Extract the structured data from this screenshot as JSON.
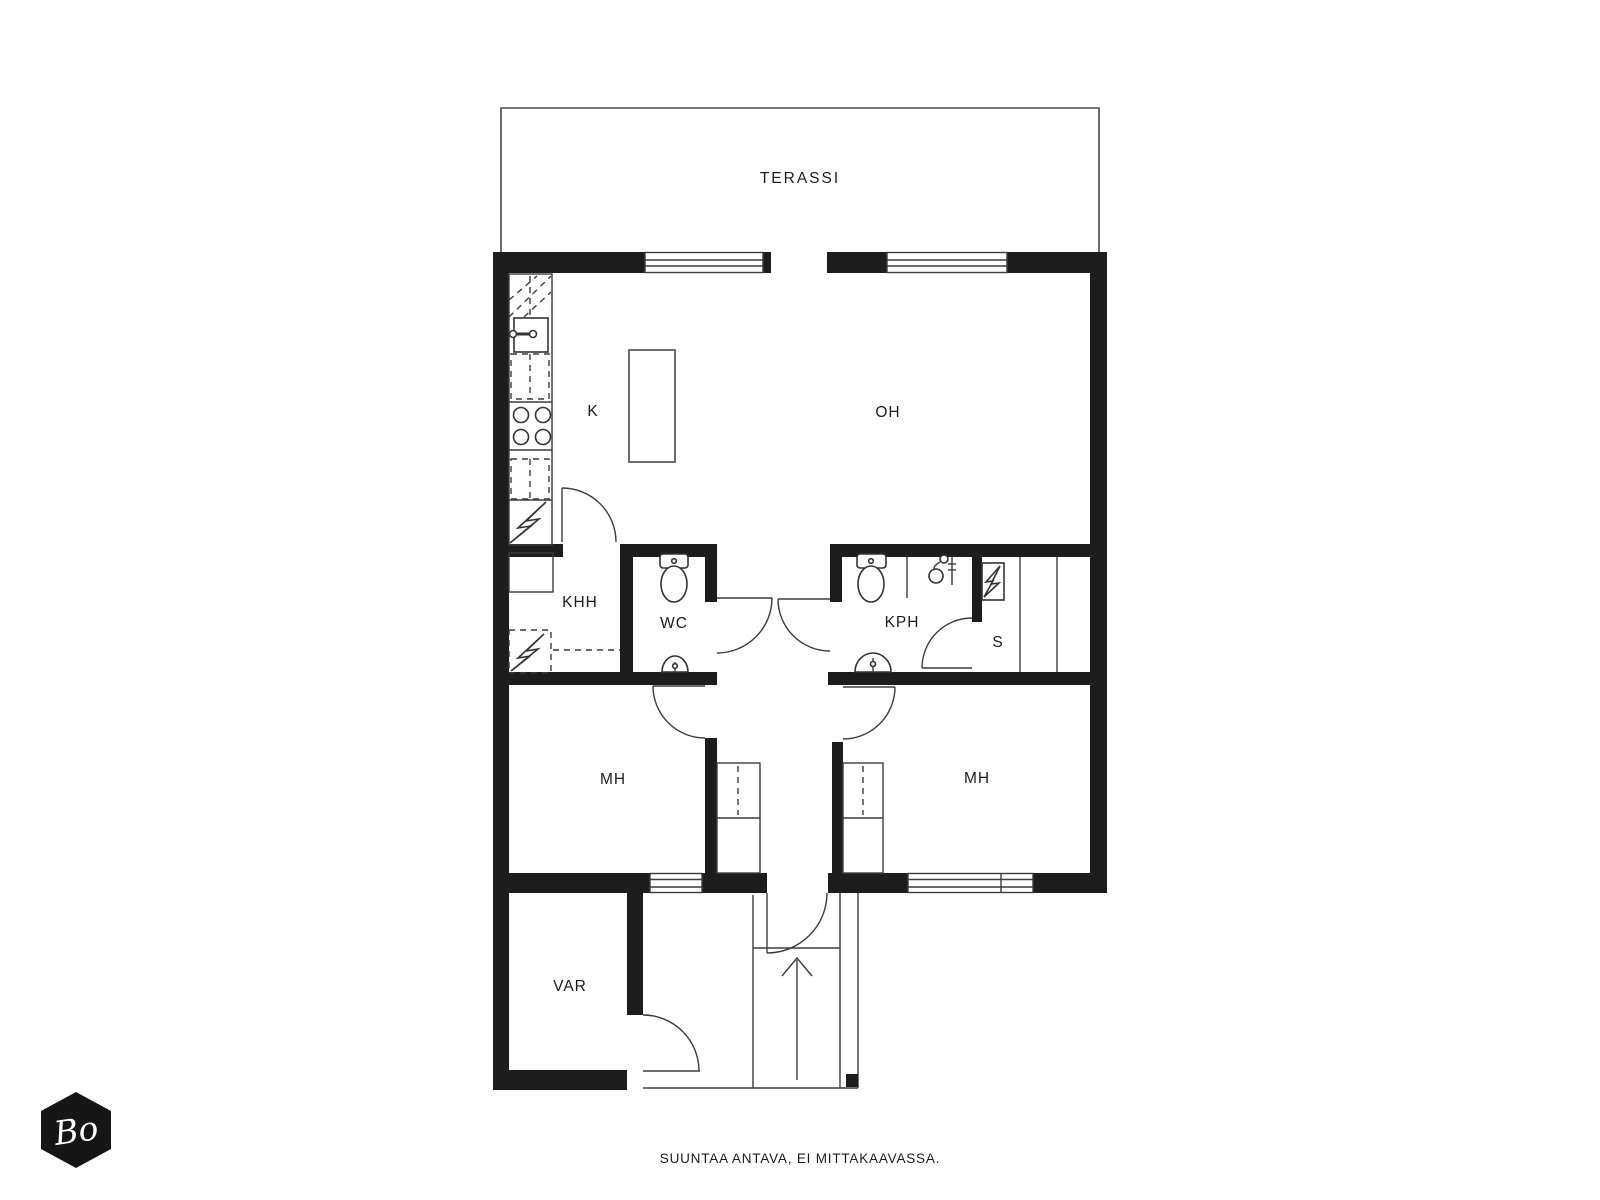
{
  "plan": {
    "rooms": {
      "terassi": {
        "label": "TERASSI"
      },
      "k": {
        "label": "K"
      },
      "oh": {
        "label": "OH"
      },
      "khh": {
        "label": "KHH"
      },
      "wc": {
        "label": "WC"
      },
      "kph": {
        "label": "KPH"
      },
      "s": {
        "label": "S"
      },
      "mh_left": {
        "label": "MH"
      },
      "mh_right": {
        "label": "MH"
      },
      "var": {
        "label": "VAR"
      }
    },
    "icons": [
      "toilet-icon",
      "sink-icon",
      "shower-icon",
      "stove-icon",
      "sauna-heater-icon",
      "electric-bolt-icon",
      "wardrobe-icon",
      "kitchen-island",
      "stairs",
      "up-arrow-icon"
    ],
    "colors": {
      "wall": "#1d1d1d",
      "line": "#4a4a4a",
      "background": "#ffffff",
      "logo_bg": "#161616",
      "logo_text": "#ffffff"
    }
  },
  "logo": {
    "text": "Bo"
  },
  "footer": {
    "disclaimer": "SUUNTAA ANTAVA, EI MITTAKAAVASSA."
  }
}
